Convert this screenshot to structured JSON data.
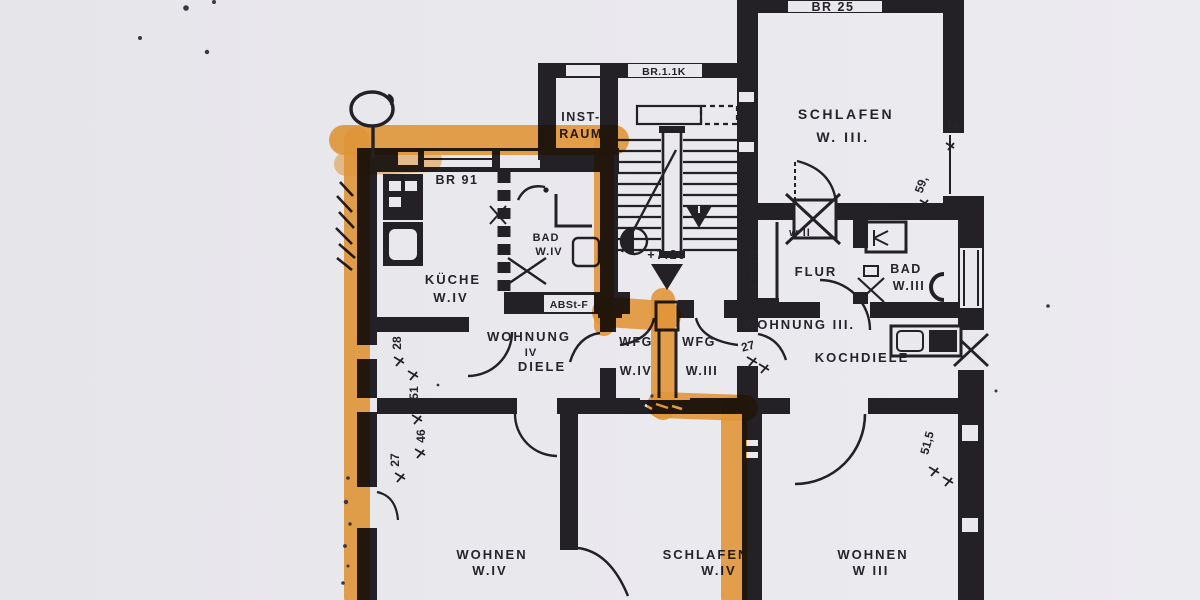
{
  "colors": {
    "highlighter": "#f6a43c",
    "ink": "#232126",
    "paper": "#e9e8ed"
  },
  "window_marks": {
    "br25": "BR 25",
    "br11k": "BR.1.1K",
    "br91": "BR 91"
  },
  "rooms": {
    "schlafen_w3_top": {
      "name": "SCHLAFEN",
      "unit": "W. III."
    },
    "inst_raum": {
      "line1": "INST-",
      "line2": "RAUM"
    },
    "kueche": {
      "name": "KÜCHE",
      "unit": "W.IV"
    },
    "bad_w4": {
      "name": "BAD",
      "unit": "W.IV"
    },
    "diele_w4": {
      "name": "WOHNUNG",
      "numeral": "IV",
      "sub": "DIELE"
    },
    "wfg_w4": {
      "name": "WFG",
      "unit": "W.IV"
    },
    "wfg_w3": {
      "name": "WFG",
      "unit": "W.III"
    },
    "abst_f": {
      "name": "ABSt-F"
    },
    "abst_fl": {
      "name": "ABSt-FL"
    },
    "flur": {
      "name": "FLUR",
      "unit": "w II"
    },
    "bad_w3": {
      "name": "BAD",
      "unit": "W.III"
    },
    "wohnung3": {
      "name": "WOHNUNG III."
    },
    "kochdiele": {
      "name": "KOCHDIELE"
    },
    "wohnen_w4": {
      "name": "WOHNEN",
      "unit": "W.IV"
    },
    "schlafen_w4": {
      "name": "SCHLAFEN",
      "unit": "W.IV"
    },
    "wohnen_w3": {
      "name": "WOHNEN",
      "unit": "W III"
    }
  },
  "level_mark": "+7.20",
  "dimensions": {
    "left": [
      "28",
      "51",
      "46",
      "27"
    ],
    "mid": "27",
    "right_top_window": "16",
    "right_top_rot": "59,",
    "right_bottom_rot": "51,5"
  }
}
